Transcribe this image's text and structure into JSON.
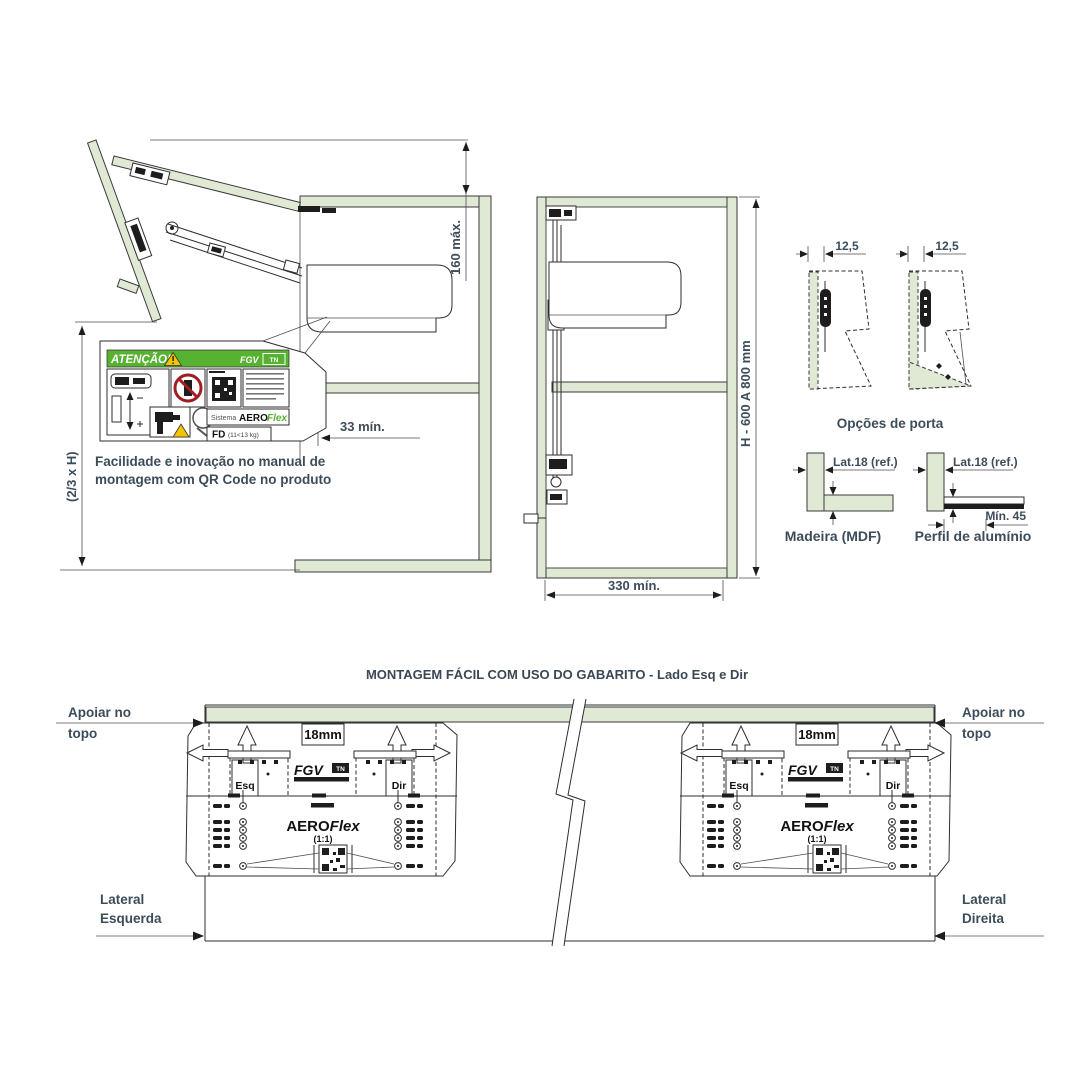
{
  "colors": {
    "panel_green": "#dfe9d4",
    "brand_green": "#56b230",
    "text_slate": "#3d4c5a",
    "warning_yellow": "#f3c300",
    "prohibition_red": "#a11d21",
    "line_black": "#2e2e2e"
  },
  "open_door_diagram": {
    "dim_top_gap": "160 máx.",
    "dim_door_height": "(2/3 x H)",
    "dim_shelf_clearance": "33 mín.",
    "caption_line1": "Facilidade e inovação no manual de",
    "caption_line2": "montagem com QR Code no produto",
    "warning_label": {
      "header": "ATENÇÃO!",
      "brand": "FGV",
      "brand_badge": "TN",
      "system_prefix": "Sistema",
      "system_bold": "AERO",
      "system_italic": "Flex",
      "model": "FD",
      "model_range": "(11<13 kg)"
    }
  },
  "closed_cabinet_diagram": {
    "dim_height": "H - 600 A 800 mm",
    "dim_width": "330 mín."
  },
  "door_options": {
    "caption": "Opções de porta",
    "dim_left": "12,5",
    "dim_right": "12,5"
  },
  "side_panel_options": {
    "wood": {
      "dim": "Lat.18 (ref.)",
      "caption": "Madeira (MDF)"
    },
    "aluminium": {
      "dim": "Lat.18 (ref.)",
      "dim_depth": "Mín. 45",
      "caption": "Perfil de alumínio"
    }
  },
  "jig_section": {
    "title": "MONTAGEM FÁCIL COM USO DO GABARITO - Lado Esq e Dir",
    "label_top_line1": "Apoiar no",
    "label_top_line2": "topo",
    "label_left_line1": "Lateral",
    "label_left_line2": "Esquerda",
    "label_right_line1": "Lateral",
    "label_right_line2": "Direita",
    "template": {
      "thickness": "18mm",
      "left_mark": "Esq",
      "right_mark": "Dir",
      "brand": "FGV",
      "brand_badge": "TN",
      "product_bold": "AERO",
      "product_italic": "Flex",
      "scale": "(1:1)"
    }
  }
}
